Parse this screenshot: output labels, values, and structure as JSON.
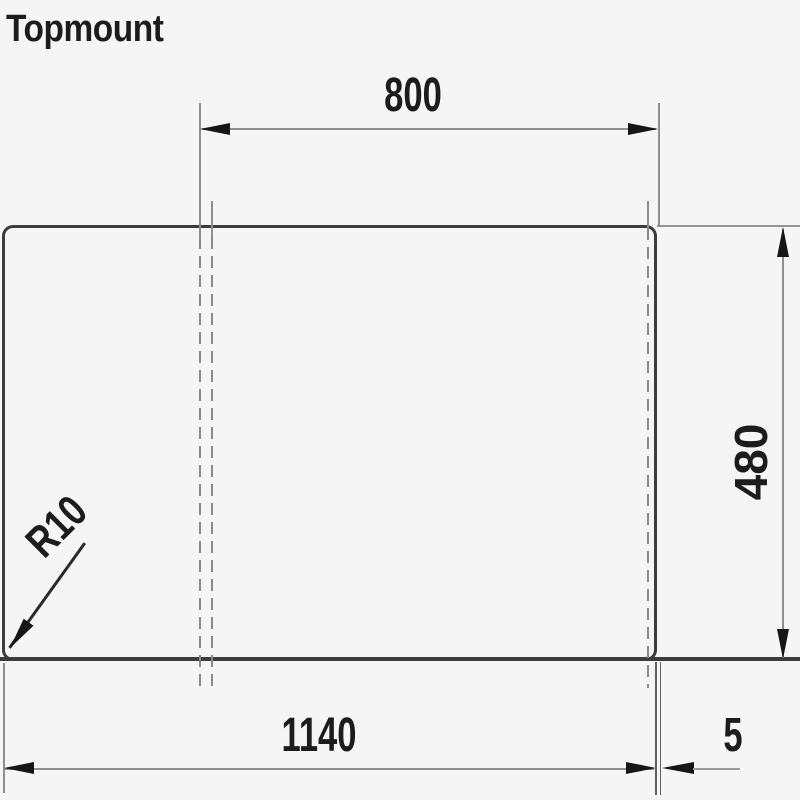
{
  "title": "Topmount",
  "dimensions": {
    "top_width": {
      "label": "800"
    },
    "right_height": {
      "label": "480"
    },
    "bottom_width": {
      "label": "1140"
    },
    "edge_offset": {
      "label": "5"
    },
    "corner_radius": {
      "label": "R10"
    }
  },
  "colors": {
    "outline": "#3c3c3c",
    "dimension_line": "#8f8f8f",
    "arrow": "#161616",
    "text": "#1c1c1c",
    "background": "#f5f5f5"
  }
}
